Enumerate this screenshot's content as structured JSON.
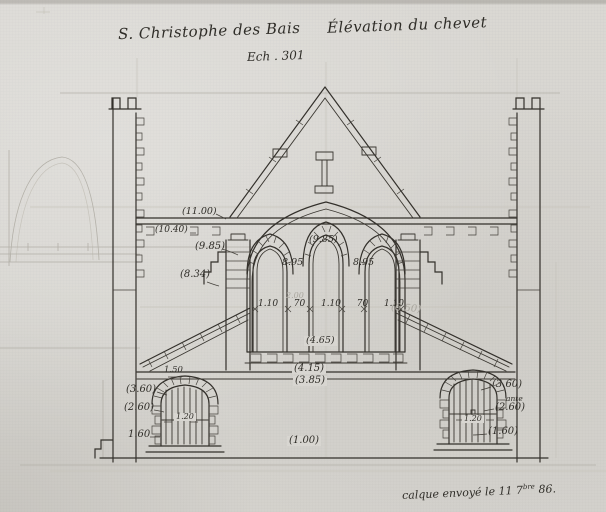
{
  "titles": {
    "main": "S. Christophe des Bais",
    "subtitle": "Élévation du chevet",
    "scale": "Ech . 301"
  },
  "footer": {
    "pre": "calque envoyé le 11 7",
    "sup": "bre",
    "post": " 86."
  },
  "dimensions": {
    "upper_left": [
      "(11.00)",
      "(10.40)",
      "(9.85)",
      "(8.34)"
    ],
    "arches": {
      "center": "(9.85)",
      "left": "8.95",
      "right": "8.95"
    },
    "bay_widths": [
      "1.10",
      "70",
      "1.10",
      "70",
      "1.10"
    ],
    "sill_level": "(4.65)",
    "string_course_upper": "(4.15)",
    "string_course_lower": "(3.85)",
    "left_window": {
      "width_over": "1.50",
      "h1": "(3.60)",
      "h2": "(2.60)",
      "h3": "1.60",
      "width_in": "1.20"
    },
    "right_window": {
      "h1": "(3.60)",
      "note": "ante",
      "h2": "(2.60)",
      "h3": "(1.60)",
      "width_in": "1.20"
    },
    "plinth": "(1.00)",
    "pencil_marks": {
      "height": "(6.50)",
      "width": "2.00"
    }
  },
  "colors": {
    "paper": "#d8d6d1",
    "ink": "#33302b",
    "pencil": "#b3b0a8"
  }
}
